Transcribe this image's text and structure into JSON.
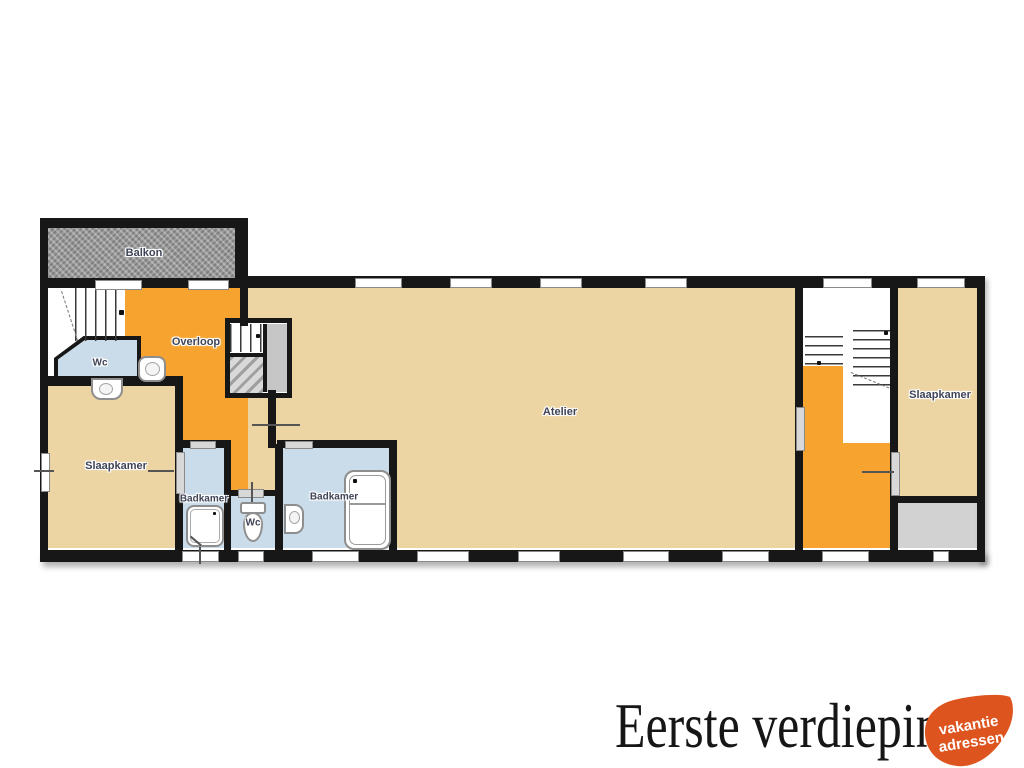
{
  "plan": {
    "floor_title": "Eerste verdieping",
    "rooms": {
      "balkon": "Balkon",
      "overloop": "Overloop",
      "wc1": "Wc",
      "slaapkamer1": "Slaapkamer",
      "badkamer1": "Badkamer",
      "wc2": "Wc",
      "badkamer2": "Badkamer",
      "atelier": "Atelier",
      "slaapkamer2": "Slaapkamer"
    },
    "colors": {
      "wall": "#171717",
      "room_tan": "#ecd5a3",
      "room_orange": "#f6a42f",
      "room_blue": "#cadcea",
      "balkon_gray": "#9b9b9b",
      "flat_roof_gray": "#d2d2d2",
      "label_text": "#3f4457"
    }
  },
  "logo": {
    "line1": "vakantie",
    "line2": "adressen",
    "color": "#dd541e"
  }
}
